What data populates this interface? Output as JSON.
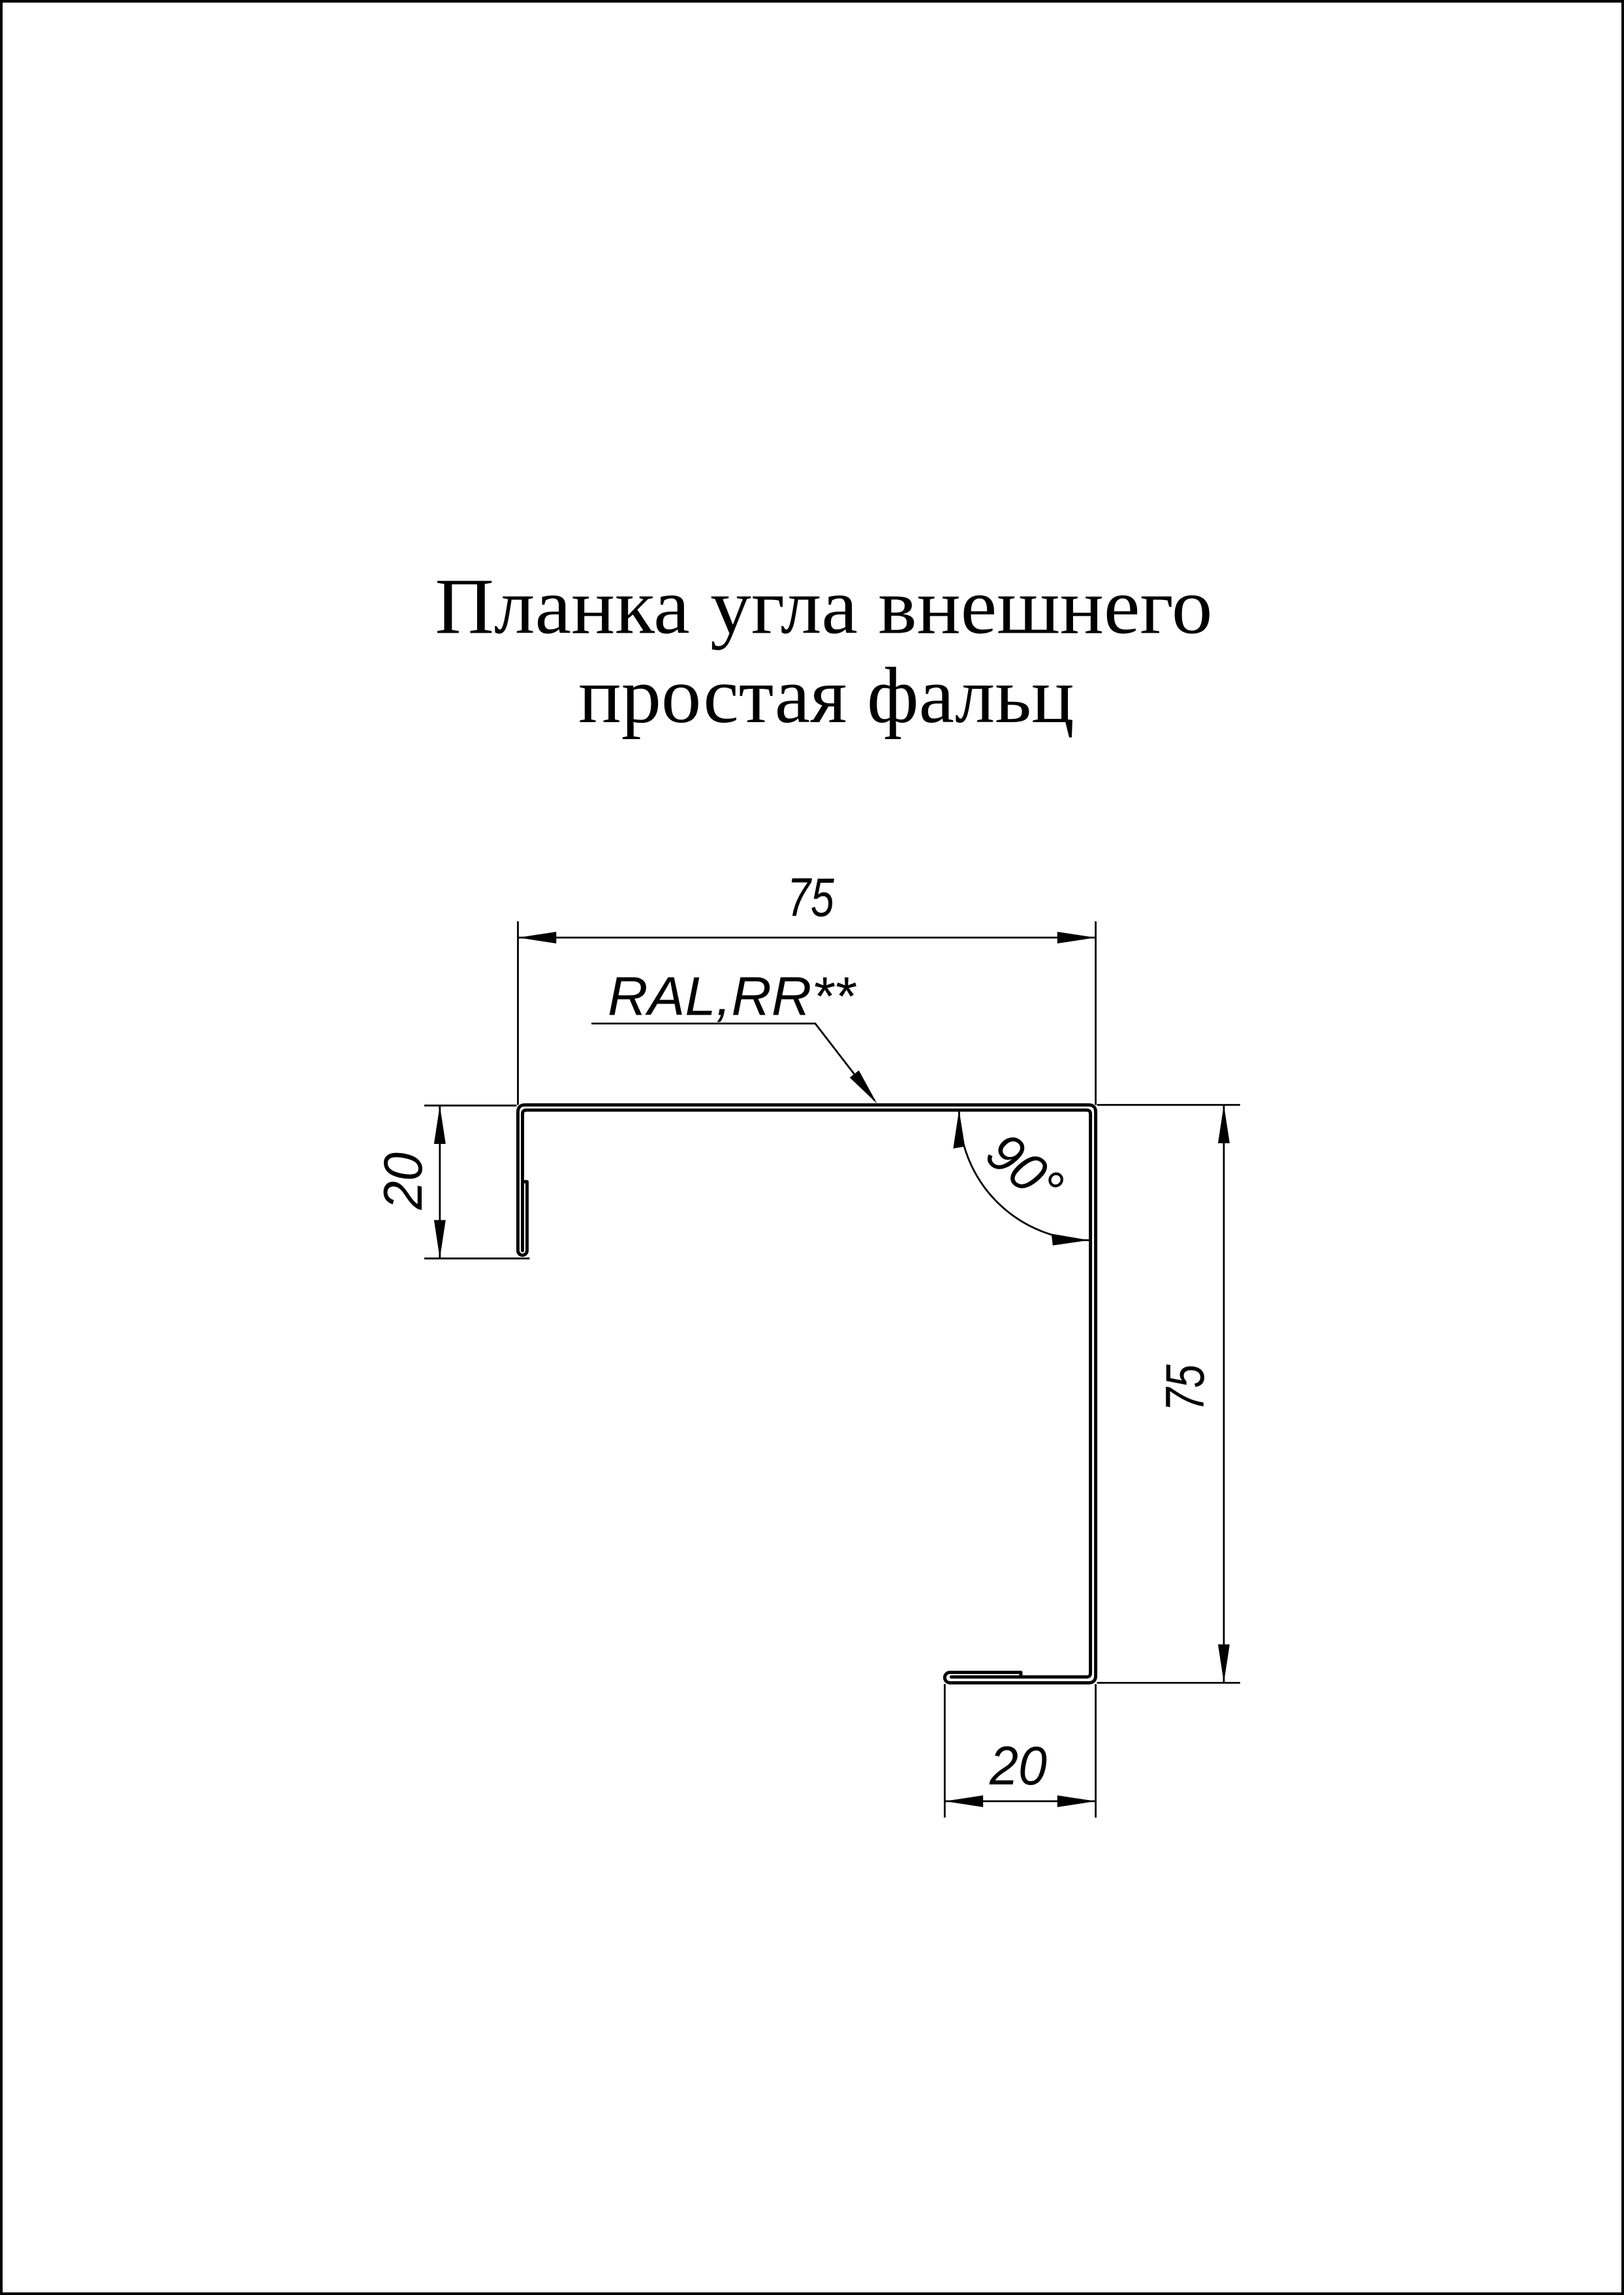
{
  "page": {
    "title": {
      "line1": "Планка угла внешнего",
      "line2": "простая фальц"
    }
  },
  "drawing": {
    "product_label": "RAL,RR**",
    "dimensions": {
      "top_width_mm": "75",
      "left_hem_flange_mm": "20",
      "right_height_mm": "75",
      "bottom_hem_flange_mm": "20",
      "bend_angle": "90°"
    }
  },
  "colors": {
    "line": "#000000",
    "background": "#ffffff"
  }
}
